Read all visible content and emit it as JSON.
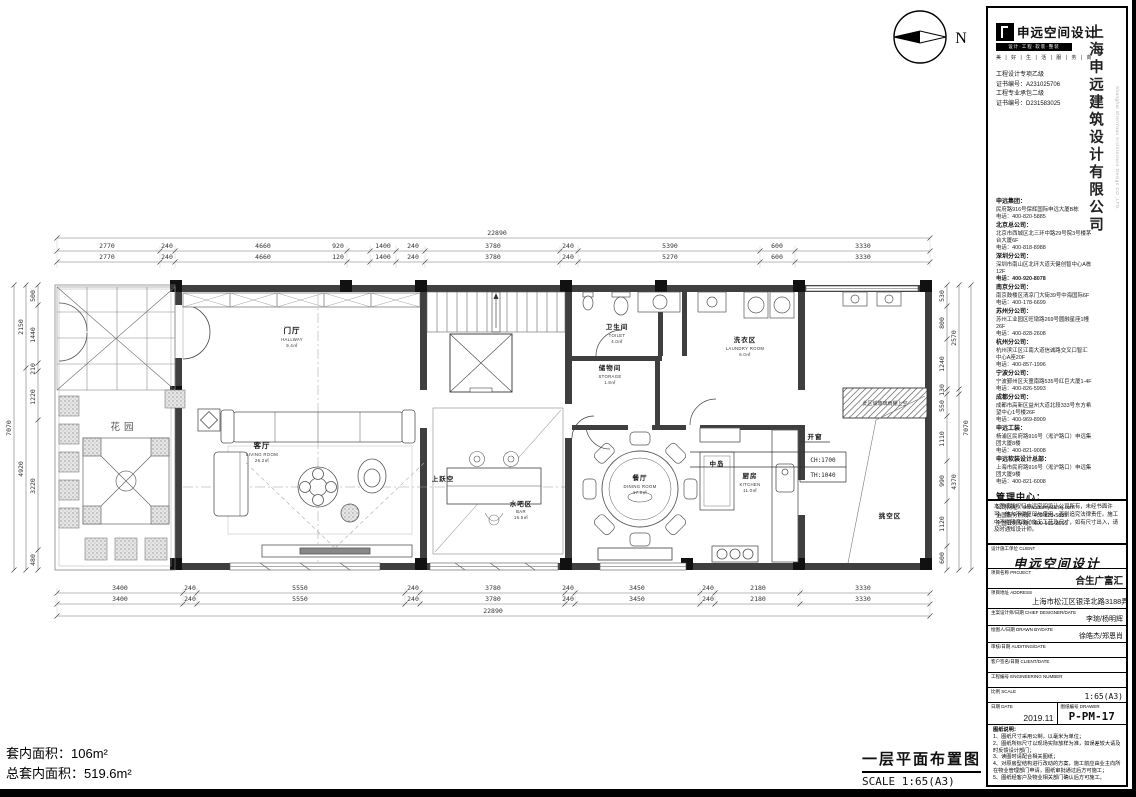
{
  "plan": {
    "labels": {
      "north": "N",
      "garden": "花园",
      "hallway": "门厅",
      "hallway_en": "HALLWAY",
      "hallway_area": "9.4㎡",
      "living": "客厅",
      "living_en": "LIVING ROOM",
      "living_area": "26.2㎡",
      "void_upper": "上跃空",
      "bar": "水吧区",
      "bar_en": "BAR",
      "bar_area": "16.5㎡",
      "toilet": "卫生间",
      "toilet_en": "TOILET",
      "toilet_area": "4.0㎡",
      "storage": "储物间",
      "storage_en": "STORAGE",
      "storage_area": "1.8㎡",
      "laundry": "洗衣区",
      "laundry_en": "LAUNDRY ROOM",
      "laundry_area": "6.0㎡",
      "dining": "餐厅",
      "dining_en": "DINING ROOM",
      "dining_area": "17.0㎡",
      "island": "中岛",
      "kitchen": "厨房",
      "kitchen_en": "KITCHEN",
      "kitchen_area": "11.0㎡",
      "void_right": "挑空区",
      "open_window": "开窗",
      "ch": "CH:1700",
      "th": "TH:1040",
      "canopy": "此区域玻璃雨棚上空"
    },
    "dims": {
      "top_total": "22890",
      "top1": [
        "2770",
        "240",
        "4660",
        "920",
        "1400",
        "240",
        "3780",
        "240",
        "5390",
        "600",
        "3330"
      ],
      "top2": [
        "2770",
        "240",
        "4660",
        "120",
        "1400",
        "240",
        "3780",
        "240",
        "5270",
        "600",
        "3330"
      ],
      "bot1": [
        "3400",
        "240",
        "5550",
        "240",
        "3780",
        "240",
        "3450",
        "240",
        "2180",
        "3330"
      ],
      "bot2": [
        "3400",
        "240",
        "5550",
        "240",
        "3780",
        "240",
        "3450",
        "240",
        "2180",
        "3330"
      ],
      "bot_total": "22890",
      "left_inner": [
        "500",
        "1440",
        "210",
        "1220",
        "3220",
        "480"
      ],
      "left_mid": [
        "2150",
        "4920"
      ],
      "left_total": "7070",
      "right_inner": [
        "530",
        "800",
        "1240",
        "130",
        "550",
        "1110",
        "990",
        "1120",
        "600"
      ],
      "right_mid": [
        "2570",
        "4370"
      ],
      "right_total": "7070"
    }
  },
  "footer": {
    "area_line1": "套内面积：106m²",
    "area_line2": "总套内面积：519.6m²",
    "drawing_title": "一层平面布置图",
    "drawing_scale": "SCALE 1:65(A3)"
  },
  "titleblock": {
    "logo_name": "申远空间设计",
    "logo_bar": "设计·工程·软装·整装",
    "tagline": "美 | 好 | 生 | 活 | 服 | 务 | 商",
    "certs": [
      "工程设计专项乙级",
      "证书编号：A231025706",
      "工程专业承包二级",
      "证书编号：D231583025"
    ],
    "company_vertical": "上海申远建筑设计有限公司",
    "company_en": "Shanghai ShenYuan Architecture Design CO.,LTD.",
    "branches": [
      {
        "name": "申远集团：",
        "addr": "民府路916号保辉国际申远大厦B栋",
        "tel": "电话：400-820-5885"
      },
      {
        "name": "北京总公司：",
        "addr": "北京市西城区北三环中路29号院3号楼茅台大厦6F",
        "tel": "电话：400-818-8988"
      },
      {
        "name": "深圳分公司：",
        "addr": "深圳市南山区北环大道天健创智中心A栋12F",
        "tel": "电话：400-920-8078"
      },
      {
        "name": "南京分公司：",
        "addr": "南京鼓楼区清凉门大街39号中海国际6F",
        "tel": "电话：400-178-6699"
      },
      {
        "name": "苏州分公司：",
        "addr": "苏州工业园区旺墩路269号圆融星座1幢26F",
        "tel": "电话：400-828-2608"
      },
      {
        "name": "杭州分公司：",
        "addr": "杭州滨江区江南大道信诚路交叉口智汇中心A座20F",
        "tel": "电话：400-857-1996"
      },
      {
        "name": "宁波分公司：",
        "addr": "宁波鄞州区天童南路535号红巨大厦1-4F",
        "tel": "电话：400-826-5993"
      },
      {
        "name": "成都分公司：",
        "addr": "成都市高新区益州大道北段333号东方希望中心1号楼26F",
        "tel": "电话：400-969-8909"
      },
      {
        "name": "申远工装：",
        "addr": "杨浦区民府路916号（淞沪路口）申远集团大厦8楼",
        "tel": "电话：400-821-9008"
      },
      {
        "name": "申远软装设计总部：",
        "addr": "上海市民府路916号（淞沪路口）申远集团大厦9楼",
        "tel": "电话：400-821-6008"
      }
    ],
    "mgmt_title": "管理中心：",
    "mgmt_site": "公司网址：www.shenyuansj.com",
    "mgmt_hotline": "全国服务热线：400-820-5885",
    "mgmt_line2": "全国业务专线：400-166-2666",
    "copyright": "本图纸版权归申远空间设计公司所有，未经书面许可，他人不得复印与使用，否则追究法律责任。施工中不得随意改动施工工艺及尺寸，如有尺寸出入，请及时通知设计师。",
    "rows": {
      "client_label": "设计施工单位 CLIENT",
      "client_value": "申远空间设计",
      "project_label": "项目名称 PROJECT",
      "project_value": "合生广富汇",
      "address_label": "项目地址 ADDRESS",
      "address_value": "上海市松江区银泽北路3188弄195号",
      "designer_label": "主案设计师/日期 CHIEF DESIGNER/DATE",
      "designer_value": "李琬/杨明辉",
      "drawnby_label": "绘图人/日期 DRAWN BY/DATE",
      "drawnby_value": "徐皓杰/郑恩肖",
      "audit_label": "审核/日期 AUDITING/DATE",
      "audit_value": "",
      "clientsign_label": "客户签名/日期 CLIENT/DATE",
      "clientsign_value": "",
      "engno_label": "工程编号 ENGINEERING NUMBER",
      "engno_value": "",
      "scale_label": "比例 SCALE",
      "scale_value": "1:65(A3)",
      "date_label": "日期 DATE",
      "date_value": "2019.11",
      "drawer_label": "图纸编号 DRAWER",
      "drawer_value": "P-PM-17"
    },
    "notes_title": "图纸说明：",
    "notes": [
      "1、图纸尺寸采用公制，以毫米为单位；",
      "2、图纸所标尺寸以现场实际放样为准，如误差较大请及时反馈设计部门；",
      "3、读图时请配合相关图纸；",
      "4、对原房型结构进行改动的方案，施工前应由业主向所在物业管理部门申请，图纸审批通过后方可施工；",
      "5、图纸经客户及物业相关部门确认后方可施工。"
    ],
    "stamp_label": "图纸确认章：",
    "stamp_en": "DRAWING CONFIRMATION STAMP",
    "stamp_hint": "（盖章）"
  }
}
